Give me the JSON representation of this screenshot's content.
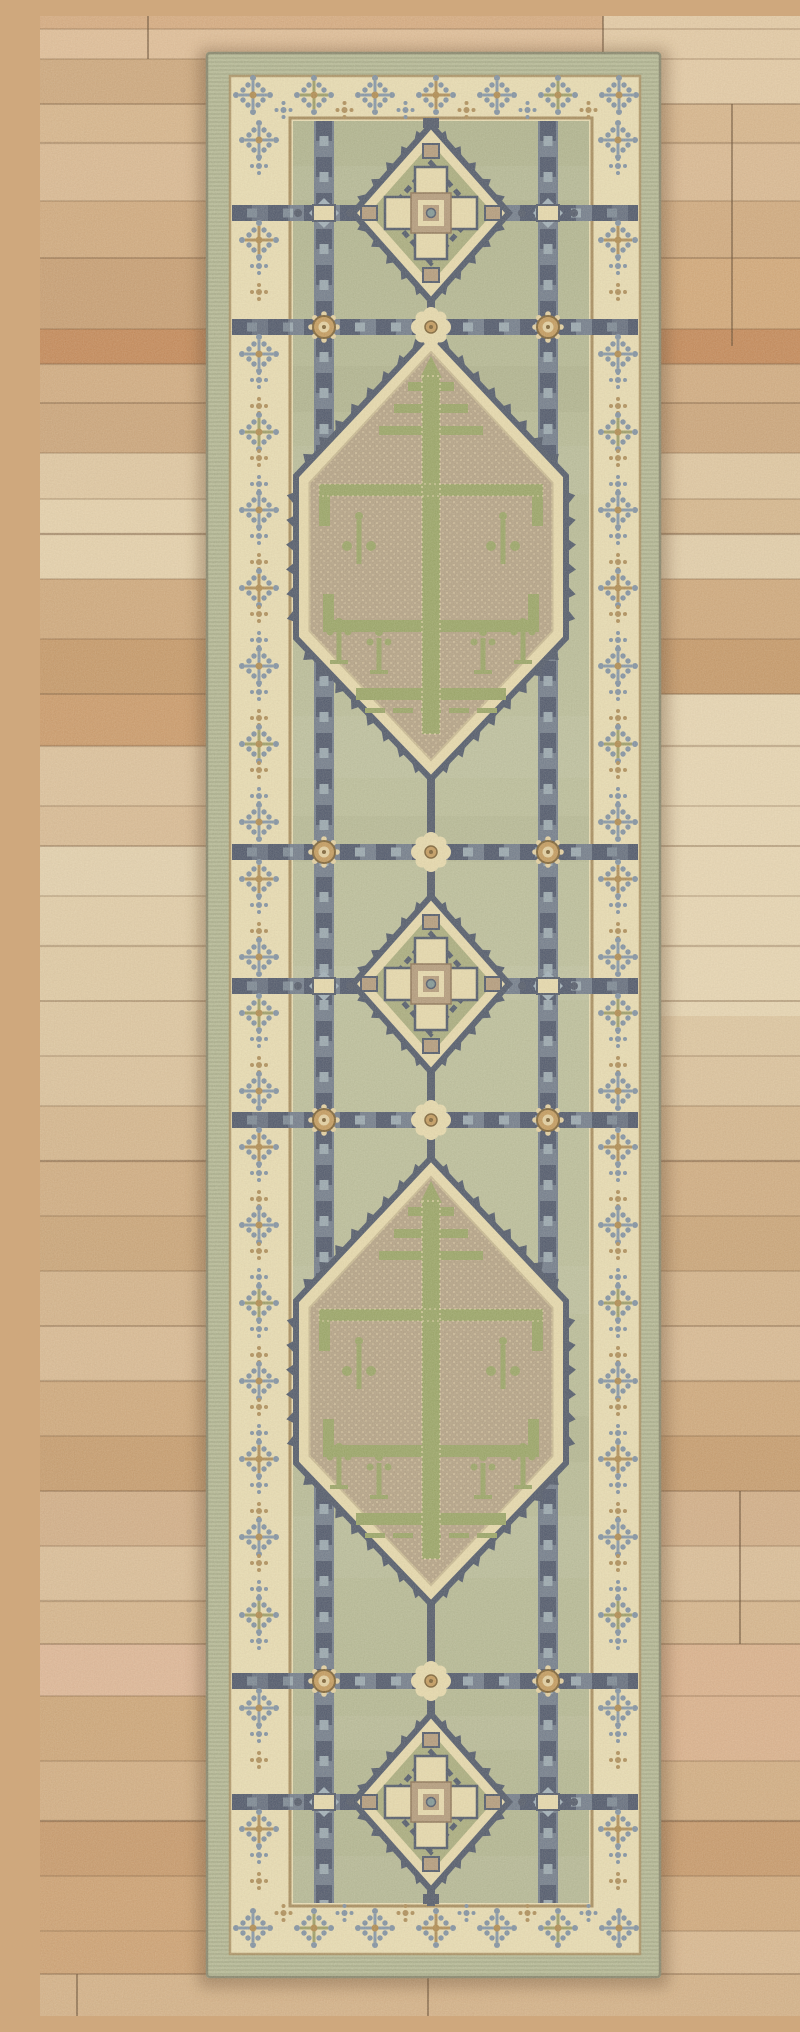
{
  "scene": {
    "description": "Vintage hand-knotted Oushak-style wool runner rug photographed from above on a rustic wood plank floor. Sage green field with blue-gray trellis lattice, cream borders filled with budded cross motifs, three stepped diamond medallions and two taupe hexagonal tree-of-life medallions.",
    "width": 800,
    "height": 2000
  },
  "floor": {
    "seam_color": "#6b4c30",
    "vseam_color": "#5e432a",
    "planks": [
      {
        "h": 13,
        "c": "#d8ab80"
      },
      {
        "h": 30,
        "c": "#e2bf99"
      },
      {
        "h": 45,
        "c": "#cfa87d"
      },
      {
        "h": 39,
        "c": "#d9b68c"
      },
      {
        "h": 58,
        "c": "#dcba93"
      },
      {
        "h": 57,
        "c": "#d2aa7e"
      },
      {
        "h": 71,
        "c": "#c99e72"
      },
      {
        "h": 35,
        "c": "#c58756"
      },
      {
        "h": 39,
        "c": "#d3ac81"
      },
      {
        "h": 50,
        "c": "#cda57a"
      },
      {
        "h": 46,
        "c": "#e2c9a3"
      },
      {
        "h": 35,
        "c": "#d8b88e"
      },
      {
        "h": 45,
        "c": "#e5d0ac"
      },
      {
        "h": 60,
        "c": "#d1a97c"
      },
      {
        "h": 55,
        "c": "#c79867"
      },
      {
        "h": 52,
        "c": "#cd9a69"
      },
      {
        "h": 60,
        "c": "#dfc39d"
      },
      {
        "h": 40,
        "c": "#dbbc95"
      },
      {
        "h": 50,
        "c": "#e6d3b0"
      },
      {
        "h": 50,
        "c": "#e4cfaa"
      },
      {
        "h": 55,
        "c": "#e2cca6"
      },
      {
        "h": 55,
        "c": "#e0c8a2"
      },
      {
        "h": 50,
        "c": "#dec49e"
      },
      {
        "h": 55,
        "c": "#d7b78e"
      },
      {
        "h": 55,
        "c": "#d2ad82"
      },
      {
        "h": 55,
        "c": "#cca578"
      },
      {
        "h": 55,
        "c": "#d6b48b"
      },
      {
        "h": 55,
        "c": "#dbbb94"
      },
      {
        "h": 55,
        "c": "#d1a97c"
      },
      {
        "h": 55,
        "c": "#c89c6d"
      },
      {
        "h": 55,
        "c": "#d4af88"
      },
      {
        "h": 55,
        "c": "#ddbf99"
      },
      {
        "h": 43,
        "c": "#d8b68d"
      },
      {
        "h": 52,
        "c": "#e1b898"
      },
      {
        "h": 65,
        "c": "#cfa678"
      },
      {
        "h": 60,
        "c": "#d4ae83"
      },
      {
        "h": 55,
        "c": "#c9996a"
      },
      {
        "h": 55,
        "c": "#d2a97c"
      },
      {
        "h": 43,
        "c": "#dbb991"
      },
      {
        "h": 42,
        "c": "#d6b288"
      }
    ],
    "patches": [
      {
        "x": 563,
        "y": 0,
        "w": 237,
        "h": 88,
        "c": "#e6cca7"
      },
      {
        "x": 621,
        "y": 678,
        "w": 179,
        "h": 322,
        "c": "#ead8b5"
      },
      {
        "x": 0,
        "y": 483,
        "w": 166,
        "h": 80,
        "c": "#e8d3ae"
      },
      {
        "x": 621,
        "y": 242,
        "w": 179,
        "h": 71,
        "c": "#d4a878"
      },
      {
        "x": 0,
        "y": 1860,
        "w": 166,
        "h": 98,
        "c": "#cfa172"
      },
      {
        "x": 621,
        "y": 1628,
        "w": 179,
        "h": 117,
        "c": "#ddb28d"
      }
    ],
    "vseams": [
      {
        "x": 563,
        "y1": 0,
        "y2": 88
      },
      {
        "x": 692,
        "y1": 88,
        "y2": 330
      },
      {
        "x": 388,
        "y1": 1958,
        "y2": 2000
      },
      {
        "x": 108,
        "y1": 0,
        "y2": 43
      },
      {
        "x": 37,
        "y1": 1958,
        "y2": 2000
      },
      {
        "x": 700,
        "y1": 1475,
        "y2": 1628
      }
    ]
  },
  "rug": {
    "frame": {
      "x": 166,
      "y": 36,
      "w": 455,
      "h": 1926
    },
    "colors": {
      "binding": "#b7bc99",
      "binding_stitch": "#9ba180",
      "edge": "#84846b",
      "border": "#ebdfb5",
      "guard": "#a68b5c",
      "field": "#b9bd98",
      "band_base": "#6e7a8c",
      "band_dark": "#49536a",
      "band_steel": "#97a7b2",
      "line": "#4d5669",
      "med_outline": "#4b5569",
      "med_cream": "#e9dcaf",
      "med_olive": "#a9ad7e",
      "med_taupe": "#b49b7c",
      "hex_field": "#b4a286",
      "hex_ring": "#c9ba93",
      "tree": "#98a565",
      "dot_teal": "#7e9697",
      "gold": "#c49a5c",
      "gold_pale": "#e6d2a3",
      "gold_dark": "#7a5f33",
      "cross_steel": "#8295a9",
      "cross_olive": "#9c9d66",
      "cross_tan": "#ae8d58",
      "cross_dot": "#7e90a4",
      "cross_center": "#b08a4e",
      "steel_light": "#9fb0bc",
      "speckle": "#ead9b0",
      "shadow": "#5f3f26"
    },
    "layout": {
      "center_x": 391,
      "field": {
        "x1": 253,
        "y1": 105,
        "x2": 549,
        "y2": 1887
      },
      "border_box": {
        "x1": 190,
        "y1": 60,
        "x2": 600,
        "y2": 1938
      },
      "vertical_bands_x": [
        284,
        508
      ],
      "horizontal_bands_y": [
        197,
        311,
        836,
        970,
        1104,
        1665,
        1786
      ],
      "square_rows_y": [
        197,
        970,
        1786
      ],
      "rosette_rows_y": [
        311,
        836,
        1104,
        1665
      ],
      "diamond_centers_y": [
        197,
        968,
        1786
      ],
      "hexagon_centers_y": [
        540,
        1365
      ],
      "side_column_x": [
        219,
        578
      ],
      "top_cross_row": {
        "y": 79,
        "dot_y": 94,
        "xs": [
          213,
          274,
          335,
          396,
          457,
          518,
          579
        ]
      },
      "bottom_cross_row": {
        "y": 1912,
        "dot_y": 1897,
        "xs": [
          213,
          274,
          335,
          396,
          457,
          518,
          579
        ]
      },
      "center_line_segments": [
        [
          104,
          114
        ],
        [
          283,
          319
        ],
        [
          761,
          882
        ],
        [
          1054,
          1144
        ],
        [
          1586,
          1700
        ],
        [
          1872,
          1890
        ]
      ]
    }
  }
}
